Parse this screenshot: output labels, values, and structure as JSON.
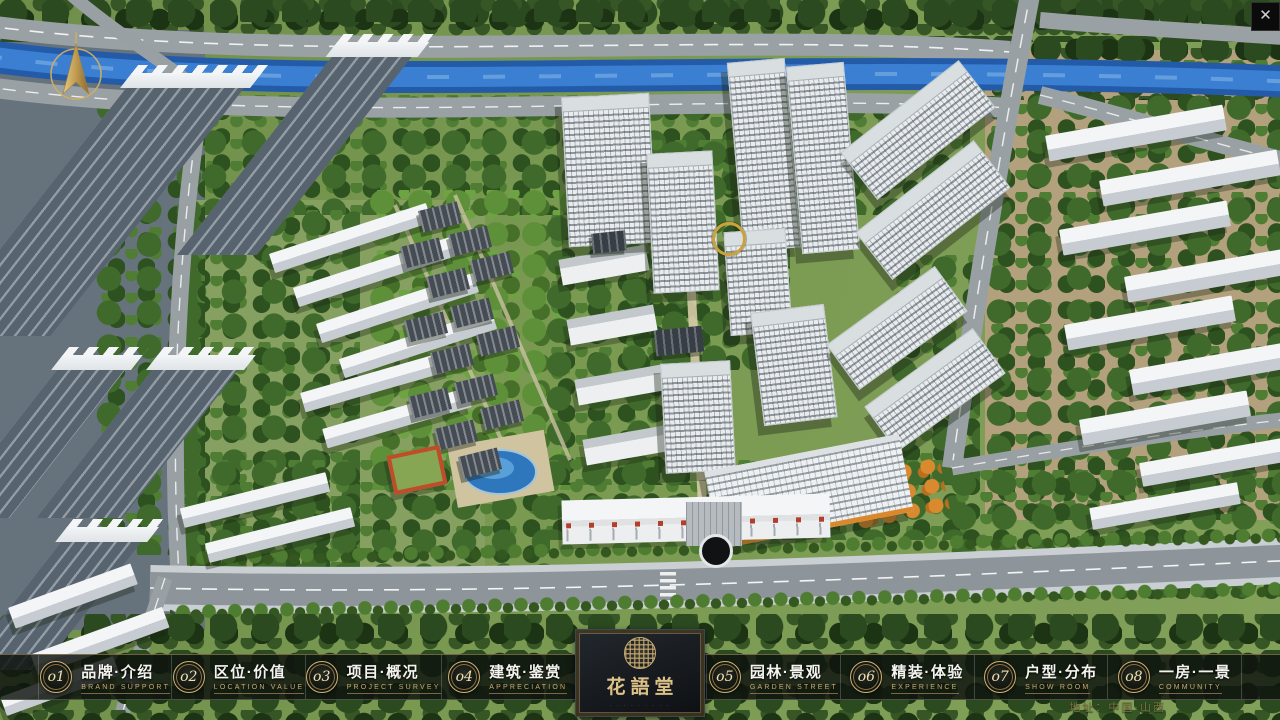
{
  "window": {
    "close": "✕"
  },
  "nav": {
    "items": [
      {
        "num": "o1",
        "title": "品牌·介绍",
        "subtitle": "BRAND SUPPORT"
      },
      {
        "num": "o2",
        "title": "区位·价值",
        "subtitle": "LOCATION VALUE"
      },
      {
        "num": "o3",
        "title": "项目·概况",
        "subtitle": "PROJECT SURVEY"
      },
      {
        "num": "o4",
        "title": "建筑·鉴赏",
        "subtitle": "APPRECIATION"
      },
      {
        "num": "o5",
        "title": "园林·景观",
        "subtitle": "GARDEN STREET"
      },
      {
        "num": "o6",
        "title": "精装·体验",
        "subtitle": "EXPERIENCE"
      },
      {
        "num": "o7",
        "title": "户型·分布",
        "subtitle": "SHOW ROOM"
      },
      {
        "num": "o8",
        "title": "一房·一景",
        "subtitle": "COMMUNITY"
      }
    ]
  },
  "logo": {
    "title": "花語堂",
    "tagline": "· · · · · · · · ·"
  },
  "footer": {
    "address": "地址：中国·山西"
  },
  "colors": {
    "gold": "#c9ab6e",
    "river_blue": "#2e6cc2",
    "bar_bg": "#0f130fd4",
    "accent_red": "#b23f2c"
  }
}
